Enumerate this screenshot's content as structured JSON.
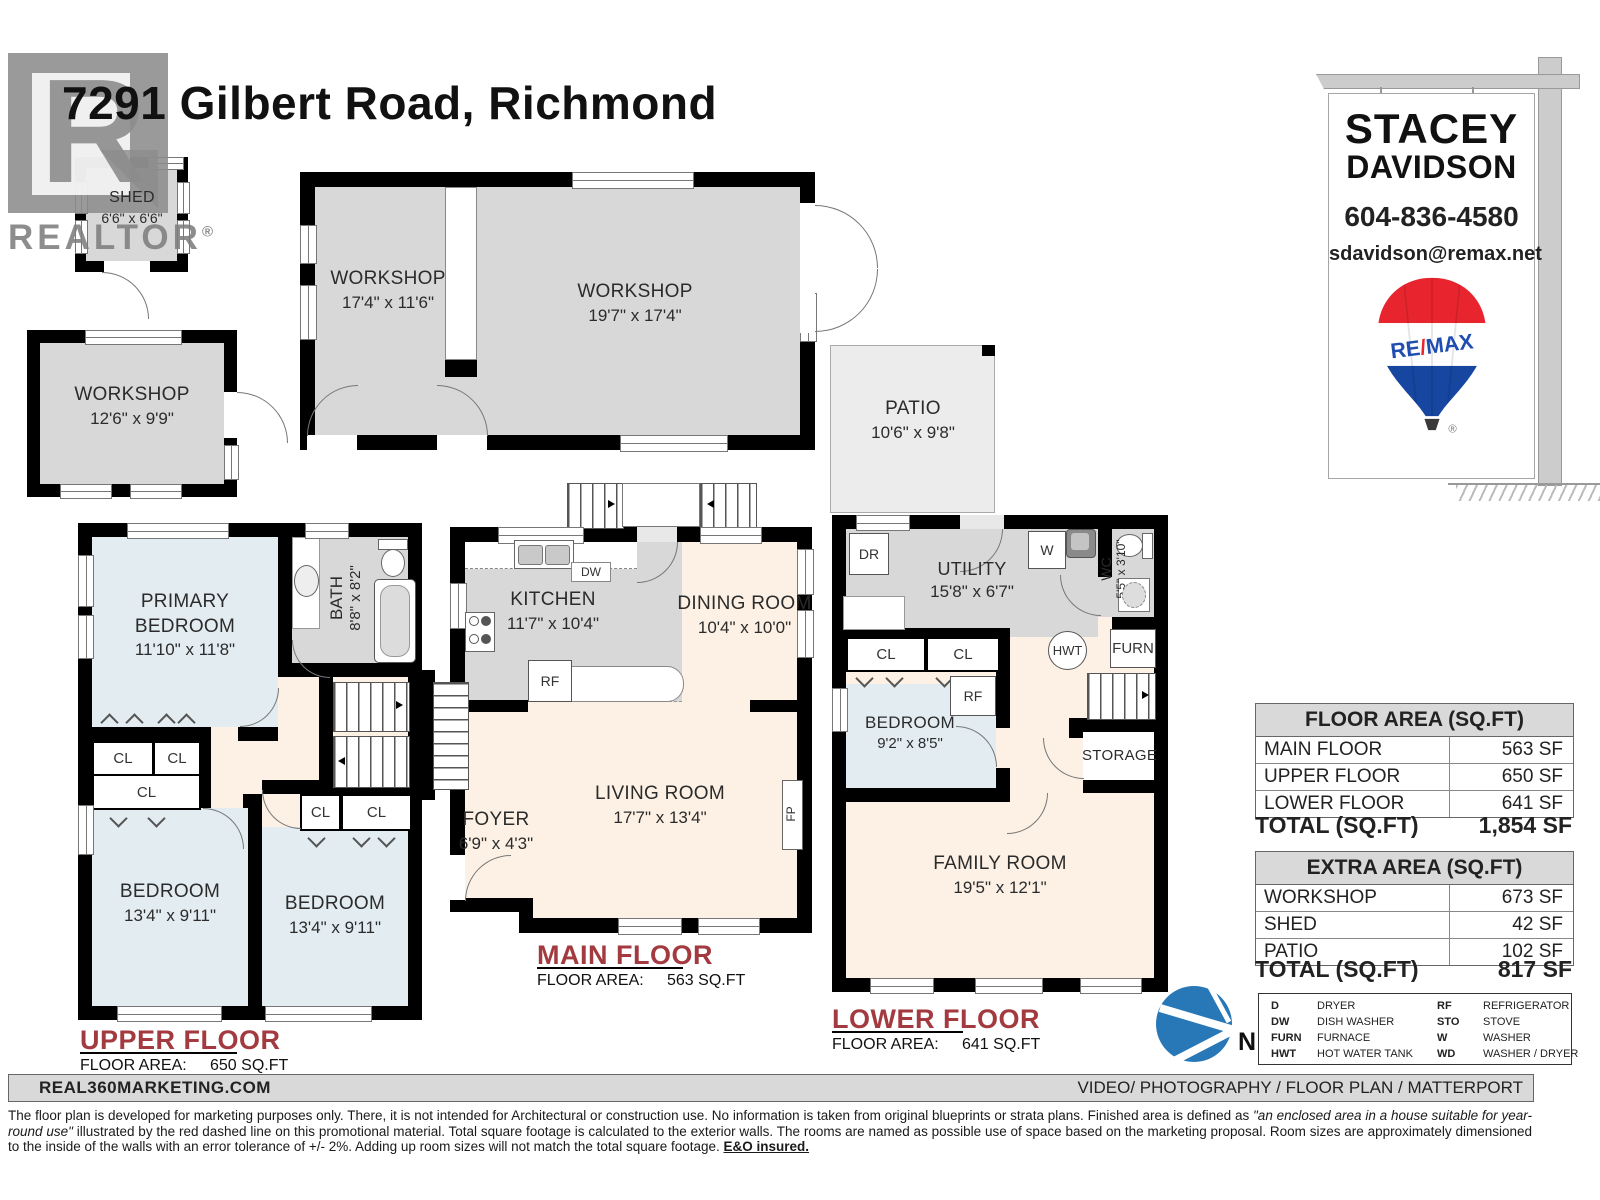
{
  "title": "7291 Gilbert Road, Richmond",
  "watermark": {
    "letter": "R",
    "text": "REALTOR",
    "reg": "®"
  },
  "agent": {
    "first": "STACEY",
    "last": "DAVIDSON",
    "phone": "604-836-4580",
    "email": "sdavidson@remax.net",
    "brand_re": "RE",
    "brand_slash": "/",
    "brand_max": "MAX",
    "reg": "®"
  },
  "colors": {
    "wall": "#000000",
    "room_gray": "#d8d8d8",
    "bedroom_blue": "#e3edf1",
    "living_cream": "#fcf1e4",
    "patio_gray": "#ececec",
    "floor_label_red": "#a23a40",
    "compass_blue": "#2878b8",
    "remax_red": "#e8252f",
    "remax_blue": "#1746a0"
  },
  "outbuildings": {
    "shed": {
      "name": "SHED",
      "dims": "6'6\" x 6'6\""
    },
    "workshop_detached": {
      "name": "WORKSHOP",
      "dims": "12'6\" x 9'9\""
    },
    "workshop_left": {
      "name": "WORKSHOP",
      "dims": "17'4\" x 11'6\""
    },
    "workshop_right": {
      "name": "WORKSHOP",
      "dims": "19'7\" x 17'4\""
    },
    "patio": {
      "name": "PATIO",
      "dims": "10'6\" x 9'8\""
    }
  },
  "upper_floor": {
    "title": "UPPER FLOOR",
    "area_label": "FLOOR AREA:",
    "area_value": "650 SQ.FT",
    "primary_bedroom": {
      "name": "PRIMARY BEDROOM",
      "dims": "11'10\" x 11'8\""
    },
    "bath": {
      "name": "BATH",
      "dims": "8'8\" x 8'2\""
    },
    "bedroom_left": {
      "name": "BEDROOM",
      "dims": "13'4\" x 9'11\""
    },
    "bedroom_right": {
      "name": "BEDROOM",
      "dims": "13'4\" x 9'11\""
    }
  },
  "main_floor": {
    "title": "MAIN FLOOR",
    "area_label": "FLOOR AREA:",
    "area_value": "563 SQ.FT",
    "kitchen": {
      "name": "KITCHEN",
      "dims": "11'7\" x 10'4\""
    },
    "dining": {
      "name": "DINING ROOM",
      "dims": "10'4\" x 10'0\""
    },
    "living": {
      "name": "LIVING ROOM",
      "dims": "17'7\" x 13'4\""
    },
    "foyer": {
      "name": "FOYER",
      "dims": "6'9\" x 4'3\""
    }
  },
  "lower_floor": {
    "title": "LOWER FLOOR",
    "area_label": "FLOOR AREA:",
    "area_value": "641 SQ.FT",
    "utility": {
      "name": "UTILITY",
      "dims": "15'8\" x 6'7\""
    },
    "wc": {
      "name": "WC",
      "dims": "5'5\" x 3'10\""
    },
    "bedroom": {
      "name": "BEDROOM",
      "dims": "9'2\" x 8'5\""
    },
    "family": {
      "name": "FAMILY ROOM",
      "dims": "19'5\" x 12'1\""
    },
    "storage": "STORAGE"
  },
  "fixtures": {
    "cl": "CL",
    "dw": "DW",
    "rf": "RF",
    "fp": "FP",
    "dr": "DR",
    "w": "W",
    "hwt": "HWT",
    "furn": "FURN"
  },
  "compass": {
    "north": "N"
  },
  "tables": {
    "floor_area": {
      "header": "FLOOR AREA (SQ.FT)",
      "rows": [
        {
          "label": "MAIN FLOOR",
          "value": "563 SF"
        },
        {
          "label": "UPPER FLOOR",
          "value": "650 SF"
        },
        {
          "label": "LOWER FLOOR",
          "value": "641 SF"
        }
      ],
      "total_label": "TOTAL (SQ.FT)",
      "total_value": "1,854 SF"
    },
    "extra_area": {
      "header": "EXTRA AREA (SQ.FT)",
      "rows": [
        {
          "label": "WORKSHOP",
          "value": "673 SF"
        },
        {
          "label": "SHED",
          "value": "42 SF"
        },
        {
          "label": "PATIO",
          "value": "102 SF"
        }
      ],
      "total_label": "TOTAL (SQ.FT)",
      "total_value": "817 SF"
    }
  },
  "legend": {
    "col1": [
      {
        "abbr": "D",
        "desc": "DRYER"
      },
      {
        "abbr": "DW",
        "desc": "DISH WASHER"
      },
      {
        "abbr": "FURN",
        "desc": "FURNACE"
      },
      {
        "abbr": "HWT",
        "desc": "HOT WATER TANK"
      }
    ],
    "col2": [
      {
        "abbr": "RF",
        "desc": "REFRIGERATOR"
      },
      {
        "abbr": "STO",
        "desc": "STOVE"
      },
      {
        "abbr": "W",
        "desc": "WASHER"
      },
      {
        "abbr": "WD",
        "desc": "WASHER / DRYER"
      }
    ]
  },
  "footer": {
    "left": "REAL360MARKETING.COM",
    "right": "VIDEO/ PHOTOGRAPHY / FLOOR PLAN / MATTERPORT",
    "disclaimer_p1": "The floor plan is developed for marketing purposes only. There, it is not intended for Architectural or construction use. No information is taken from original blueprints or strata plans. Finished area is defined as ",
    "disclaimer_italic": "\"an enclosed area in a house suitable for year-round use\"",
    "disclaimer_p2": " illustrated by the red dashed line on this promotional material. Total square footage is calculated to the exterior walls. The rooms are named as possible use of space based on the marketing proposal. Room sizes are approximately dimensioned to the inside of the walls with an error tolerance of +/- 2%. Adding up room sizes will not match the total square footage. ",
    "disclaimer_bold": "E&O insured."
  }
}
